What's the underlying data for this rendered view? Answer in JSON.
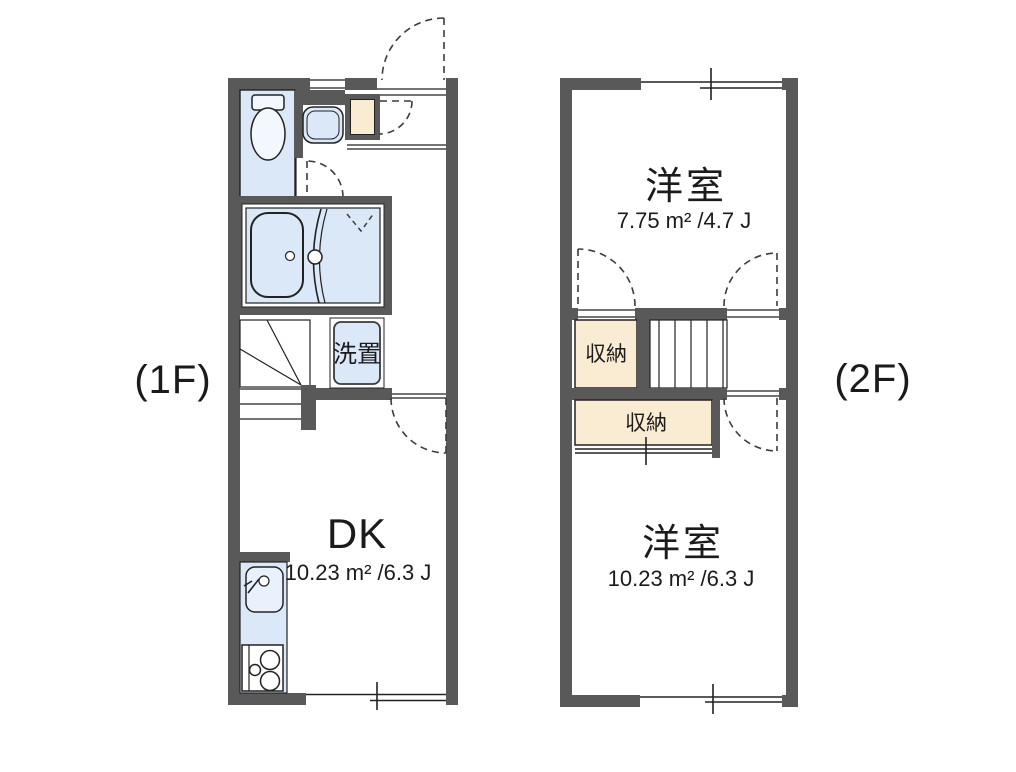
{
  "title": "Two-story apartment floor plan",
  "colors": {
    "wall": "#595959",
    "water_fixture_fill": "#dbe8f8",
    "storage_fill": "#faecd2",
    "line": "#222222",
    "background": "#ffffff"
  },
  "floor1": {
    "label": "(1F)",
    "rooms": {
      "dk": {
        "name": "DK",
        "area": "10.23 m² /6.3 J"
      },
      "laundry": {
        "name": "洗置"
      }
    }
  },
  "floor2": {
    "label": "(2F)",
    "rooms": {
      "bedroom_upper": {
        "name": "洋室",
        "area": "7.75 m² /4.7 J"
      },
      "storage_upper": {
        "name": "収納"
      },
      "storage_lower": {
        "name": "収納"
      },
      "bedroom_lower": {
        "name": "洋室",
        "area": "10.23 m² /6.3 J"
      }
    }
  }
}
